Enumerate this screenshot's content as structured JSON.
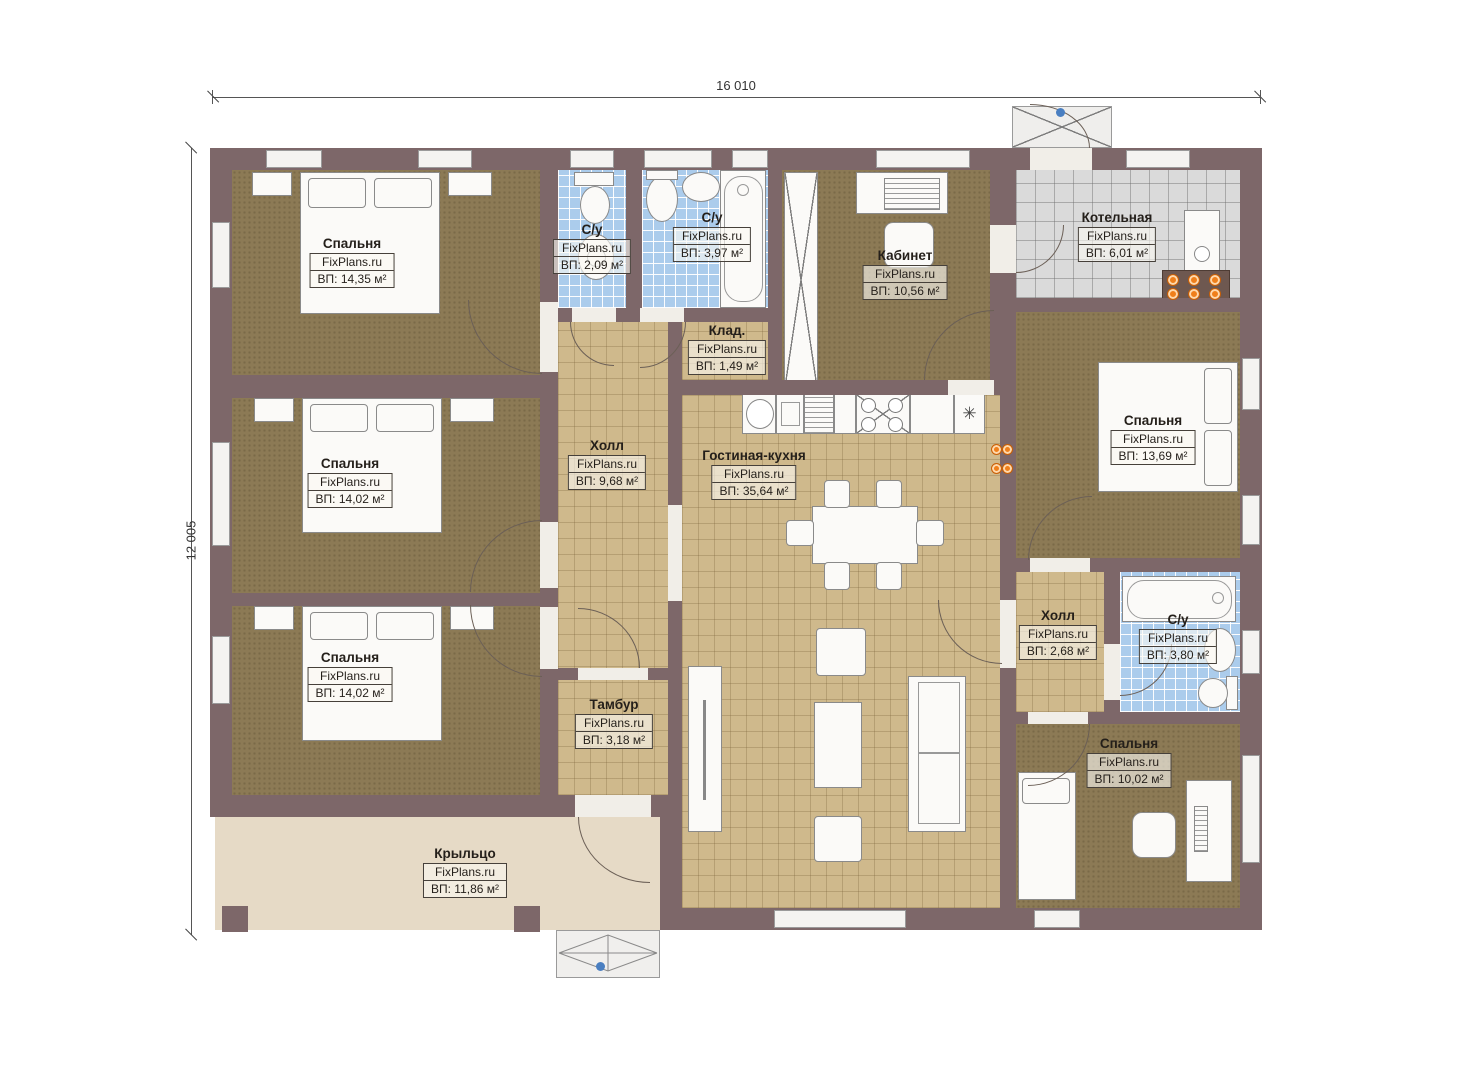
{
  "brand": "FixPlans.ru",
  "dimensions": {
    "top": "16 010",
    "left": "12 005"
  },
  "rooms": [
    {
      "name": "Спальня",
      "area": "ВП: 14,35 м²"
    },
    {
      "name": "С/у",
      "area": "ВП: 2,09 м²"
    },
    {
      "name": "С/у",
      "area": "ВП: 3,97 м²"
    },
    {
      "name": "Кабинет",
      "area": "ВП: 10,56 м²"
    },
    {
      "name": "Котельная",
      "area": "ВП: 6,01 м²"
    },
    {
      "name": "Клад.",
      "area": "ВП: 1,49 м²"
    },
    {
      "name": "Холл",
      "area": "ВП: 9,68 м²"
    },
    {
      "name": "Гостиная-кухня",
      "area": "ВП: 35,64 м²"
    },
    {
      "name": "Спальня",
      "area": "ВП: 13,69 м²"
    },
    {
      "name": "Спальня",
      "area": "ВП: 14,02 м²"
    },
    {
      "name": "Спальня",
      "area": "ВП: 14,02 м²"
    },
    {
      "name": "Тамбур",
      "area": "ВП: 3,18 м²"
    },
    {
      "name": "Холл",
      "area": "ВП: 2,68 м²"
    },
    {
      "name": "С/у",
      "area": "ВП: 3,80 м²"
    },
    {
      "name": "Спальня",
      "area": "ВП: 10,02 м²"
    },
    {
      "name": "Крыльцо",
      "area": "ВП: 11,86 м²"
    }
  ],
  "icons": {
    "fridge": "✳"
  },
  "colors": {
    "wall": "#7d6769",
    "bedroom_floor": "#8c7a55",
    "tile_tan": "#cfb98c",
    "tile_blue": "#abccec",
    "tile_gray": "#dadada",
    "porch": "#e6dac6",
    "socket_orange": "#f07f1a",
    "marker_blue": "#4a7fc1"
  }
}
